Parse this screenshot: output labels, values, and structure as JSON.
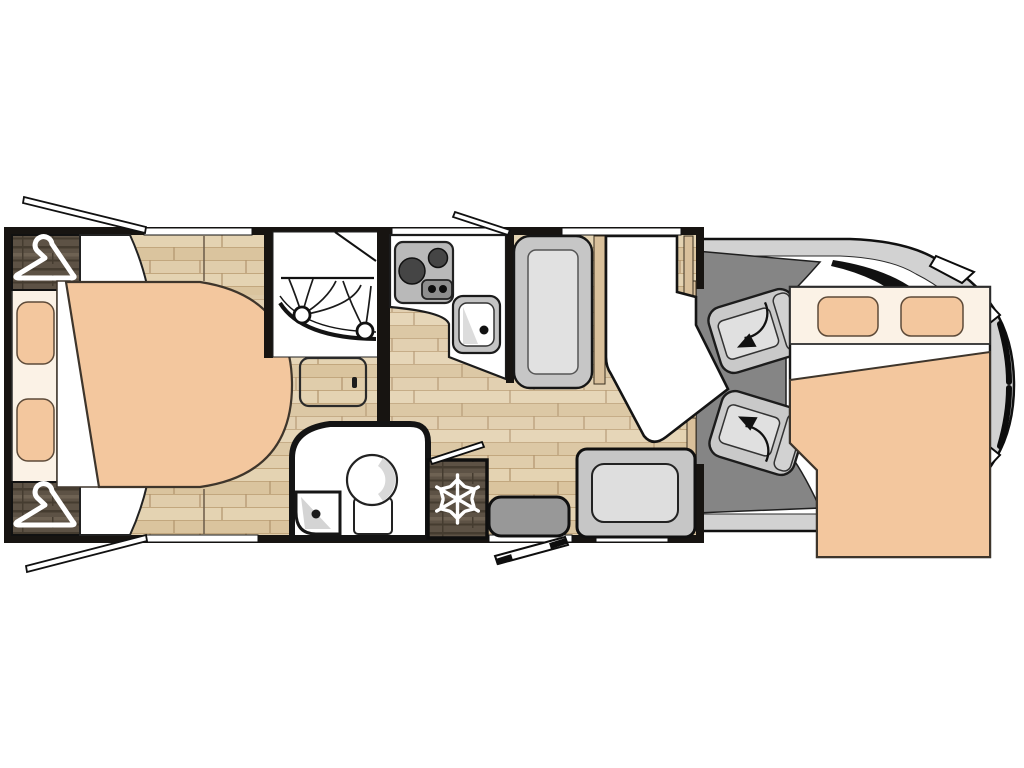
{
  "meta": {
    "title": "Motorhome floor plan — top-down layout diagram",
    "view": "top-down",
    "canvas_width": 1024,
    "canvas_height": 768
  },
  "palette": {
    "wall": "#171411",
    "room_white": "#ffffff",
    "cream": "#fbf2e6",
    "peach": "#f3c79e",
    "cab_floor": "#858585",
    "body_gray": "#d2d2d2",
    "bench_gray": "#c6c6c6",
    "bench_light": "#e1e1e1",
    "seat_gray": "#c9c9c9",
    "seat_back": "#d2d2d2",
    "seat_light": "#e0e0e0",
    "metal": "#b9b9b9",
    "metal_dark": "#454545",
    "panel": "#8e8e8e",
    "step_gray": "#989898",
    "trim_wood": "#d9c09b",
    "ink": "#111111",
    "floor_a": "#e4d3b2",
    "floor_b": "#dac49e",
    "floor_c": "#e0cdab",
    "floor_line": "#c2a77e",
    "floor_seam": "#b1946d",
    "darkwood": "#5d5245",
    "darkwood_dark": "#453c30",
    "darkwood_light": "#6e6253"
  },
  "fixtures": [
    {
      "name": "rear-wardrobe",
      "icon": "clothes-hanger-icon",
      "count": 2
    },
    {
      "name": "rear-island-bed",
      "count": 1
    },
    {
      "name": "bed-pillow",
      "count": 4
    },
    {
      "name": "shower-cubicle",
      "icon": "shower-curtain",
      "count": 1
    },
    {
      "name": "floor-step-hatch",
      "count": 1
    },
    {
      "name": "toilet",
      "count": 1
    },
    {
      "name": "washbasin",
      "count": 2
    },
    {
      "name": "two-burner-hob",
      "icon": "gas-hob-icon",
      "count": 1
    },
    {
      "name": "kitchen-sink",
      "count": 1
    },
    {
      "name": "refrigerator",
      "icon": "snowflake-icon",
      "count": 1
    },
    {
      "name": "dinette-bench",
      "count": 1
    },
    {
      "name": "dinette-table",
      "count": 1
    },
    {
      "name": "travel-seat",
      "count": 1
    },
    {
      "name": "entrance-step",
      "count": 1
    },
    {
      "name": "entrance-door-open",
      "count": 1
    },
    {
      "name": "wall-window",
      "count": 5
    },
    {
      "name": "open-window-pane",
      "count": 3
    },
    {
      "name": "swivel-cab-seat",
      "icon": "rotate-arrow-icon",
      "count": 2
    },
    {
      "name": "drop-down-bed",
      "count": 1
    },
    {
      "name": "vehicle-cab-body",
      "count": 1
    }
  ]
}
